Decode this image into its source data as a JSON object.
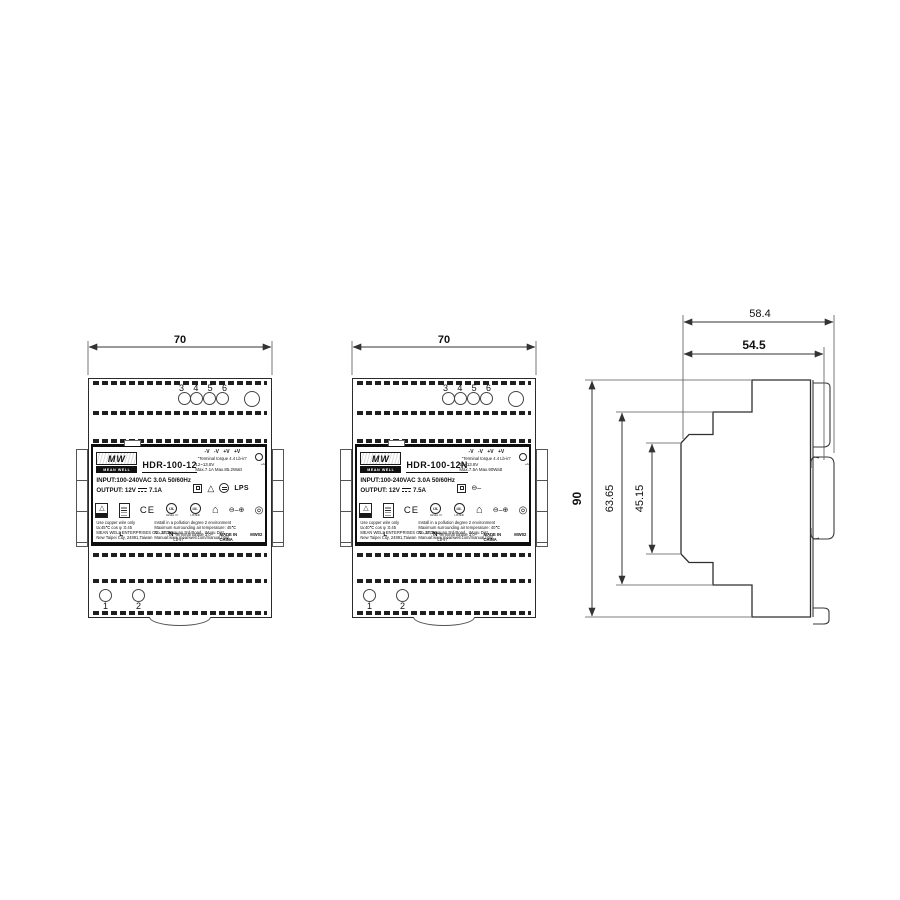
{
  "units": [
    {
      "model": "HDR-100-12",
      "brand": "MEAN WELL",
      "brand_short": "MW",
      "width_dim": "70",
      "top_terminals": [
        "3",
        "4",
        "5",
        "6"
      ],
      "bottom_terminals": [
        "1",
        "2"
      ],
      "polarity_row": "-V  -V  +V  +V",
      "torque_top": "\"Terminal torque 4.4 Lb-in\"",
      "v_range": "12~13.8V",
      "max_line": "Max.7.1A   Max.85.2Watt",
      "input_line": "INPUT:100-240VAC  3.0A  50/60Hz",
      "output_prefix": "OUTPUT: 12V",
      "output_current": "7.1A",
      "notes": [
        [
          "Use copper wire only",
          "Install in a  pollution degree 2 environment"
        ],
        [
          "ta:45℃   cos φ :0.45",
          "Maximum surrounding air temperature: 45℃"
        ],
        [
          "MEAN WELL ENTERPRISES CO., LTD.",
          "No.28, Wuquan 3rd Road., Wugu Dist.,"
        ],
        [
          "New Taipei City, 24891,Taiwan",
          "Manual:www.meanwell.com/manual.html"
        ]
      ],
      "line_l": "L",
      "line_n": "N",
      "torque_bottom": "\"Terminal torque 3.0 Lb-in\"",
      "made_in": "MADE IN CHINA",
      "code": "MW02"
    },
    {
      "model": "HDR-100-12N",
      "brand": "MEAN WELL",
      "brand_short": "MW",
      "width_dim": "70",
      "top_terminals": [
        "3",
        "4",
        "5",
        "6"
      ],
      "bottom_terminals": [
        "1",
        "2"
      ],
      "polarity_row": "-V  -V  +V  +V",
      "torque_top": "\"Terminal torque 4.4 Lb-in\"",
      "v_range": "12~13.8V",
      "max_line": "Max.7.5A   Max.90Watt",
      "input_line": "INPUT:100-240VAC  3.0A  50/60Hz",
      "output_prefix": "OUTPUT: 12V",
      "output_current": "7.5A",
      "notes": [
        [
          "Use copper wire only",
          "Install in a  pollution degree 2 environment"
        ],
        [
          "ta:40℃   cos φ :0.45",
          "Maximum surrounding air temperature: 40℃"
        ],
        [
          "MEAN WELL ENTERPRISES CO., LTD.",
          "No.28, Wuquan 3rd Road., Wugu Dist.,"
        ],
        [
          "New Taipei City, 24891,Taiwan",
          "Manual:www.meanwell.com/manual.html"
        ]
      ],
      "line_l": "L",
      "line_n": "N",
      "torque_bottom": "\"Terminal torque 3.0 Lb-in\"",
      "made_in": "MADE IN CHINA",
      "code": "MW02"
    }
  ],
  "icons": {
    "triangle_glyph": "△",
    "house_glyph": "⌂",
    "spiral_glyph": "◎",
    "polarity_glyph": "⊖–⊕",
    "polarity_short": "⊖–",
    "ce_mark": "CE",
    "lps_mark": "LPS",
    "ul_mark": "UL",
    "listed_label": "LISTED",
    "level_label": "LEVEL VI",
    "vadj_mark": "+Adj"
  },
  "side": {
    "depth_total": "58.4",
    "depth_body": "54.5",
    "height": "90",
    "inner_height": "63.65",
    "face_height": "45.15"
  }
}
